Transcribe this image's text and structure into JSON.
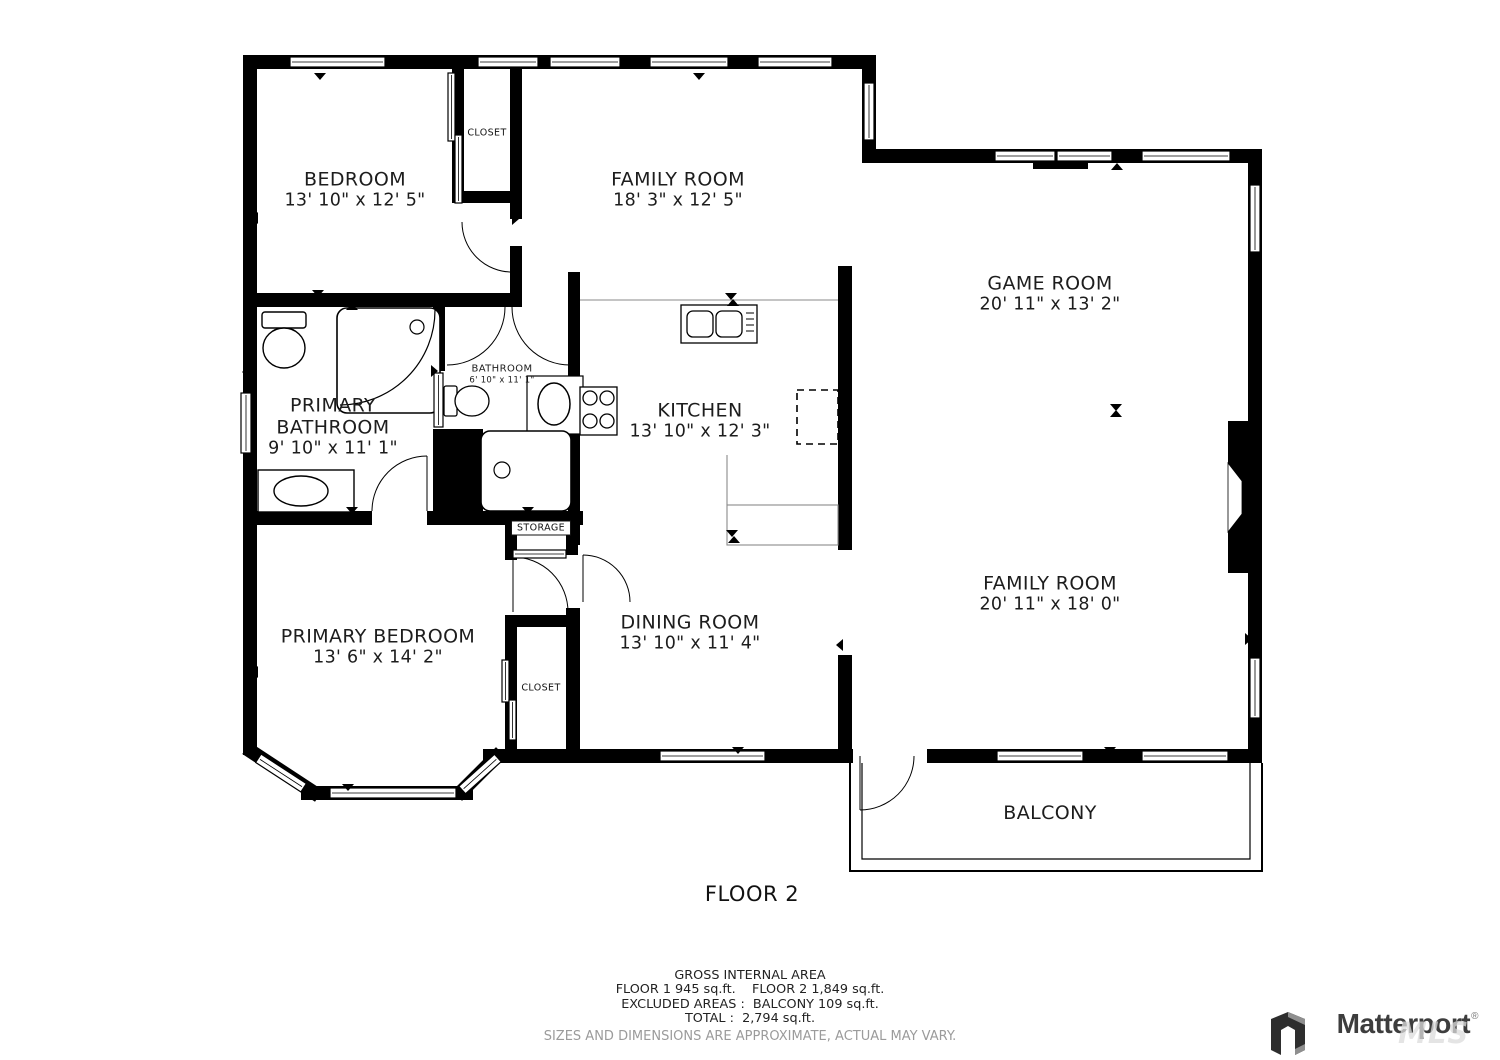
{
  "plan": {
    "floor_label": "FLOOR 2",
    "rooms": {
      "bedroom": {
        "name": "BEDROOM",
        "dims": "13' 10\" x 12' 5\""
      },
      "family_room_top": {
        "name": "FAMILY ROOM",
        "dims": "18' 3\" x 12' 5\""
      },
      "game_room": {
        "name": "GAME ROOM",
        "dims": "20' 11\" x 13' 2\""
      },
      "primary_bathroom": {
        "name_line1": "PRIMARY",
        "name_line2": "BATHROOM",
        "dims": "9' 10\" x 11' 1\""
      },
      "bathroom": {
        "name": "BATHROOM",
        "dims": "6' 10\" x 11' 1\""
      },
      "kitchen": {
        "name": "KITCHEN",
        "dims": "13' 10\" x 12' 3\""
      },
      "primary_bedroom": {
        "name": "PRIMARY BEDROOM",
        "dims": "13' 6\" x 14' 2\""
      },
      "dining_room": {
        "name": "DINING ROOM",
        "dims": "13' 10\" x 11' 4\""
      },
      "family_room_bottom": {
        "name": "FAMILY ROOM",
        "dims": "20' 11\" x 18' 0\""
      },
      "balcony": {
        "name": "BALCONY"
      },
      "closet_top": {
        "name": "CLOSET"
      },
      "closet_bottom": {
        "name": "CLOSET"
      },
      "storage": {
        "name": "STORAGE"
      }
    }
  },
  "footer": {
    "title": "GROSS INTERNAL AREA",
    "areas_line": "FLOOR 1 945 sq.ft.    FLOOR 2 1,849 sq.ft.",
    "excluded_line": "EXCLUDED AREAS :  BALCONY 109 sq.ft.",
    "total_line": "TOTAL :  2,794 sq.ft.",
    "disclaimer": "SIZES AND DIMENSIONS ARE APPROXIMATE, ACTUAL MAY VARY."
  },
  "brand": {
    "name": "Matterport",
    "registered_mark": "®",
    "watermark": "MLS"
  },
  "colors": {
    "wall": "#000000",
    "label_text": "#1d1d1d",
    "disclaimer_text": "#9b9b9b",
    "brand_text": "#3d3d3d"
  }
}
